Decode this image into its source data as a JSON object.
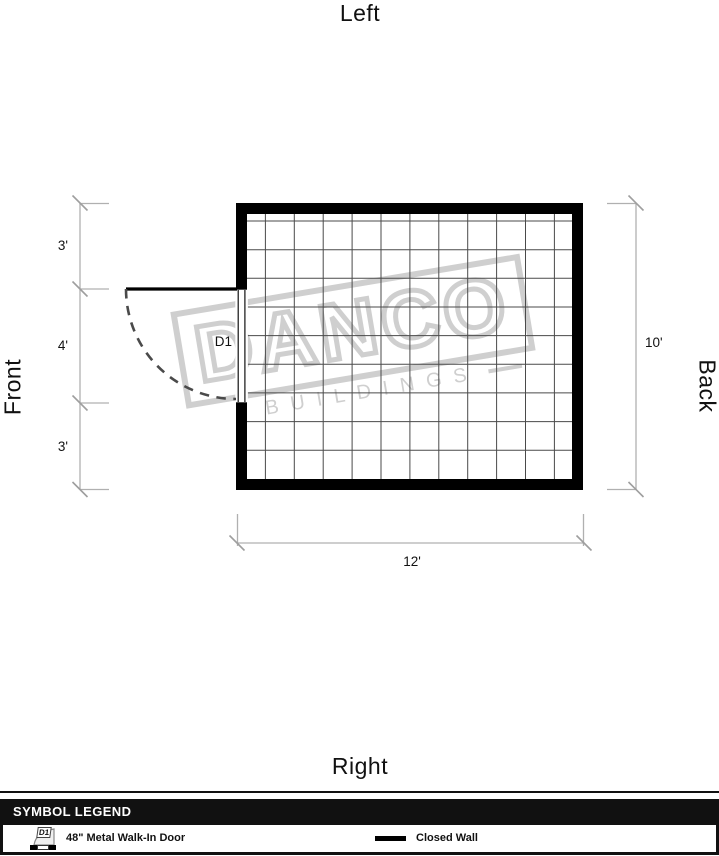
{
  "orientation_labels": {
    "top": "Left",
    "bottom": "Right",
    "left": "Front",
    "right": "Back"
  },
  "plan": {
    "door_label": "D1",
    "dimensions": {
      "left_segments": [
        "3'",
        "4'",
        "3'"
      ],
      "right_total": "10'",
      "bottom_total": "12'"
    },
    "grid": {
      "columns": 12,
      "rows": 10
    }
  },
  "watermark": {
    "line1": "DANCO",
    "line2": "BUILDINGS"
  },
  "legend": {
    "header": "SYMBOL LEGEND",
    "items": [
      {
        "symbol": "door-swing",
        "badge": "D1",
        "label": "48\" Metal Walk-In Door"
      },
      {
        "symbol": "closed-wall",
        "label": "Closed Wall"
      }
    ]
  },
  "colors": {
    "wall": "#000000",
    "grid_line": "#4a4a4a",
    "dimension_line": "#b0b0b0",
    "watermark": "#cfcfcf",
    "legend_header_bg": "#111111"
  }
}
